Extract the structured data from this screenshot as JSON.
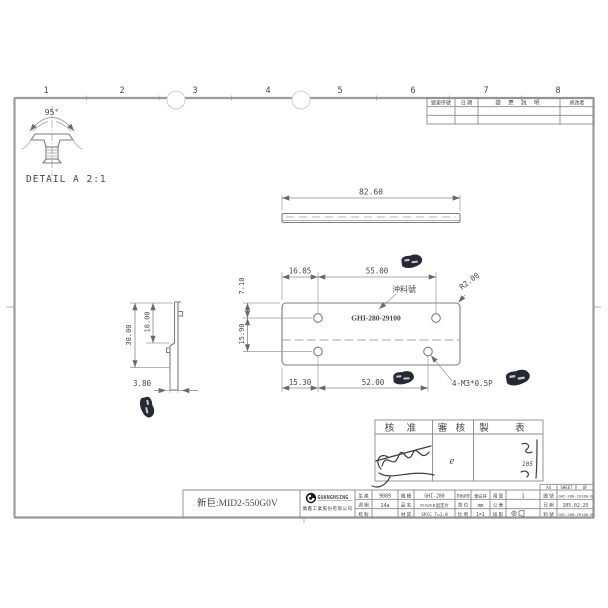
{
  "sheet": {
    "column_numbers": [
      "1",
      "2",
      "3",
      "4",
      "5",
      "6",
      "7",
      "8"
    ]
  },
  "revision_table": {
    "col_change_no": "變更序號",
    "col_date": "日 期",
    "col_description": "變 更 說 明",
    "col_modifier": "修改者"
  },
  "detail_view": {
    "angle": "95°",
    "label": "DETAIL A 2:1"
  },
  "top_view": {
    "length": "82.60"
  },
  "front_view": {
    "dim_left_top": "16.05",
    "dim_hole_span_top": "55.00",
    "dim_edge_to_hole": "7.10",
    "dim_hole_rows": "15.90",
    "dim_left_bottom": "15.30",
    "dim_hole_span_bottom": "52.00",
    "corner_radius": "R2.00",
    "hole_callout": "4-M3*0.5P",
    "stamp_note_label": "沖料號",
    "part_marking": "GHI-280-29100"
  },
  "side_view": {
    "dim_total_height": "30.00",
    "dim_inner_height": "18.00",
    "dim_depth": "3.80"
  },
  "approval_table": {
    "col_approved": "核 准",
    "col_reviewed": "審 核",
    "col_prepared": "製 表",
    "sig_reviewed": "e",
    "sig_prepared_note": "105"
  },
  "title_block": {
    "company_en": "GUANGHSING",
    "company_zh": "廣鑫工業股份有限公司",
    "paper_size": "A4",
    "sheet_label": "SHEET",
    "of_label": "OF",
    "fields": {
      "production_label": "生 產",
      "production": "9089",
      "cycle_label": "週 期",
      "cycle": "14a",
      "check_label": "校 對",
      "check": "",
      "model_label": "機 種",
      "model": "GHI-280",
      "product_label": "品 名",
      "product": "POWER固定片",
      "material_label": "材 質",
      "material": "SPCC T=1.0",
      "finish_label": "表面處理",
      "finish": "鍍白鋅",
      "unit_label": "單 位",
      "unit": "mm",
      "scale_label": "比 例",
      "scale": "1=1",
      "qty_label": "用 量",
      "qty": "1",
      "tolerance_label": "公 差",
      "tolerance": "",
      "projection_label": "投 影",
      "projection_icon": "third-angle-projection",
      "drawing_no_label": "圖 號",
      "drawing_no": "GHI-280-29100-B",
      "date_label": "日 期",
      "date": "105.02.25",
      "part_no_label": "料 號",
      "part_no": "GHI-280-29100-B"
    }
  },
  "footer": {
    "customer_note": "新巨:MID2-550G0V"
  },
  "colors": {
    "line": "#8c8c8c",
    "ink_stamp": "#262833",
    "text": "#3f3f3f"
  }
}
